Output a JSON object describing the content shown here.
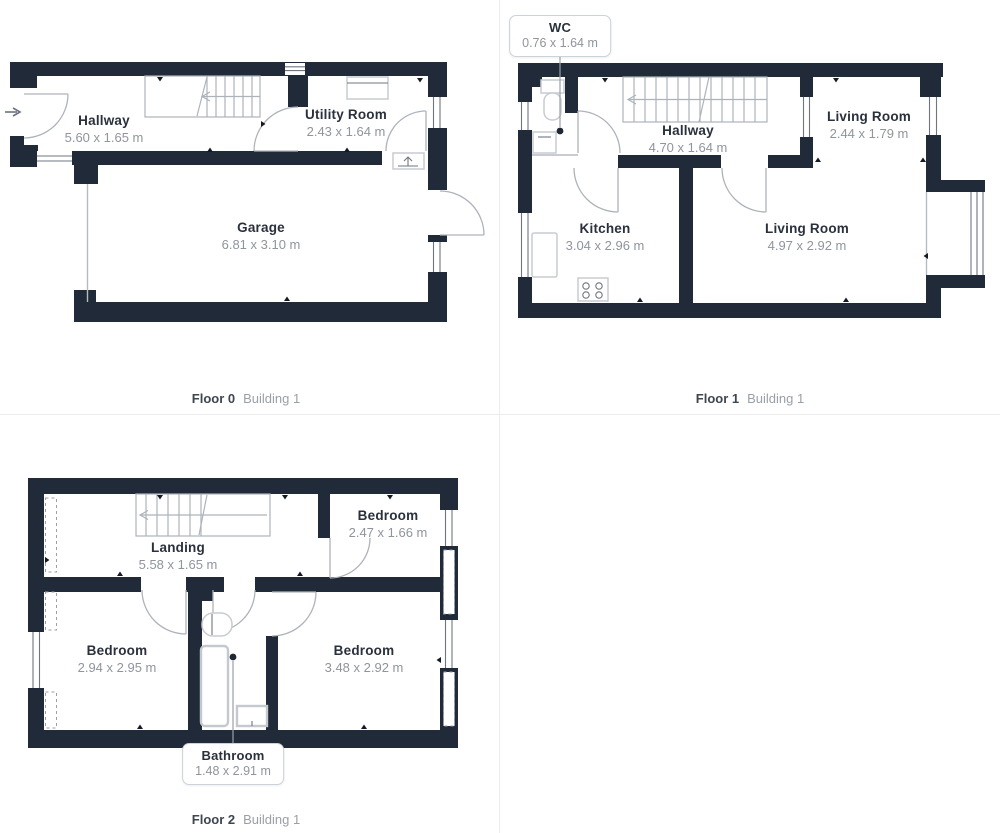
{
  "colors": {
    "wall": "#212a38",
    "door_arc": "#adb3bb",
    "room_name_text": "#2a313c",
    "dimension_text": "#8f959d",
    "caption_muted": "#9aa0a8",
    "background": "#ffffff"
  },
  "floors": [
    {
      "id": "floor-0",
      "caption": {
        "floor": "Floor 0",
        "building": "Building 1"
      },
      "rooms": [
        {
          "name": "Hallway",
          "dims": "5.60 x 1.65 m"
        },
        {
          "name": "Utility Room",
          "dims": "2.43 x 1.64 m"
        },
        {
          "name": "Garage",
          "dims": "6.81 x 3.10 m"
        }
      ]
    },
    {
      "id": "floor-1",
      "caption": {
        "floor": "Floor 1",
        "building": "Building 1"
      },
      "callout": {
        "name": "WC",
        "dims": "0.76 x 1.64 m"
      },
      "rooms": [
        {
          "name": "Hallway",
          "dims": "4.70 x 1.64 m"
        },
        {
          "name": "Living Room",
          "dims": "2.44 x 1.79 m"
        },
        {
          "name": "Kitchen",
          "dims": "3.04 x 2.96 m"
        },
        {
          "name": "Living Room",
          "dims": "4.97 x 2.92 m"
        }
      ]
    },
    {
      "id": "floor-2",
      "caption": {
        "floor": "Floor 2",
        "building": "Building 1"
      },
      "callout": {
        "name": "Bathroom",
        "dims": "1.48 x 2.91 m"
      },
      "rooms": [
        {
          "name": "Landing",
          "dims": "5.58 x 1.65 m"
        },
        {
          "name": "Bedroom",
          "dims": "2.47 x 1.66 m"
        },
        {
          "name": "Bedroom",
          "dims": "2.94 x 2.95 m"
        },
        {
          "name": "Bedroom",
          "dims": "3.48 x 2.92 m"
        }
      ]
    }
  ]
}
